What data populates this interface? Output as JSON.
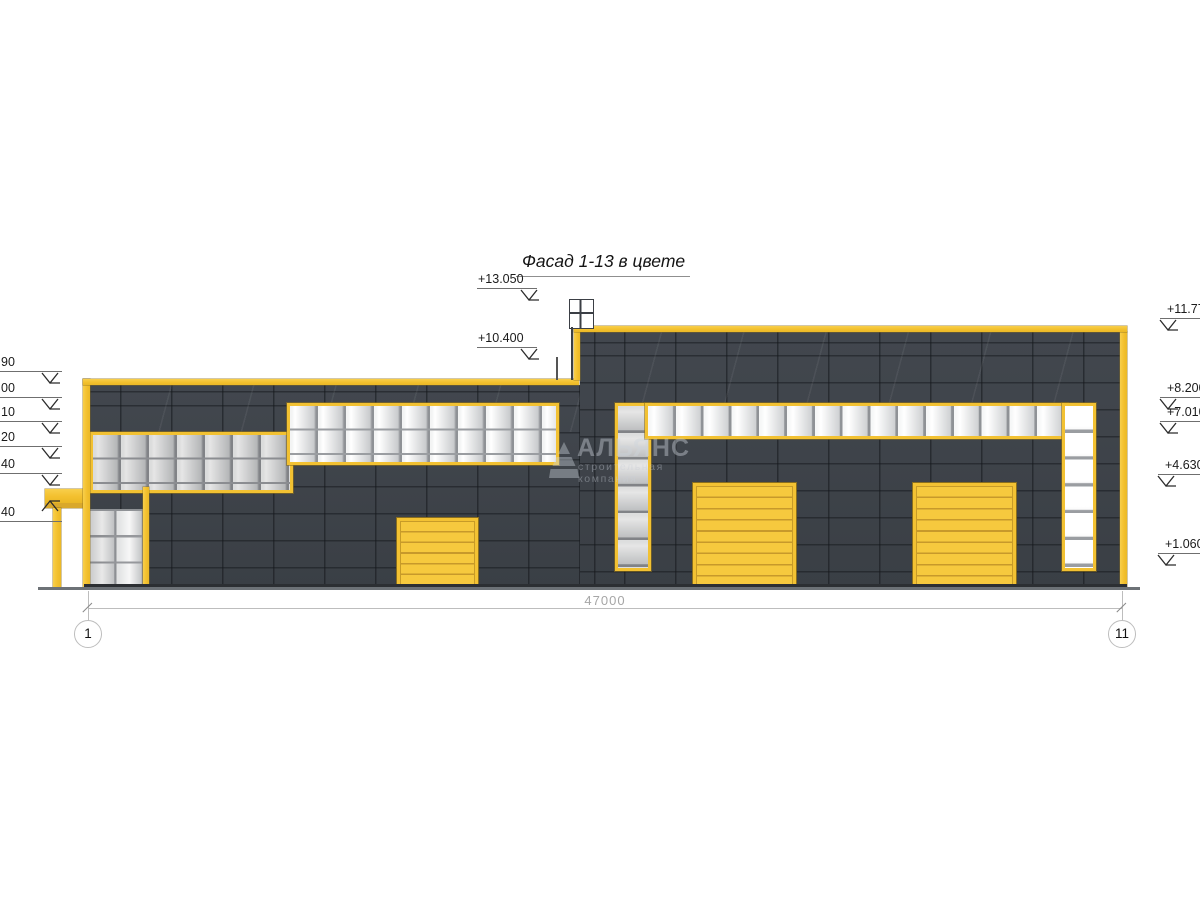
{
  "drawing": {
    "title": "Фасад 1-13 в цвете",
    "dimension_total": "47000",
    "axis_left": "1",
    "axis_right": "11",
    "watermark": {
      "name": "АЛЬЯНС",
      "tagline": "строительная компания"
    },
    "elevation_markers": [
      {
        "label": "+13.050",
        "tx": 478,
        "tw": 52,
        "x": 477,
        "w": 60,
        "y": 288,
        "ax": 528,
        "dir": "down"
      },
      {
        "label": "+10.400",
        "tx": 478,
        "tw": 52,
        "x": 477,
        "w": 60,
        "y": 347,
        "ax": 528,
        "dir": "down"
      },
      {
        "label": "+11.770",
        "tx": 1167,
        "tw": 60,
        "x": 1160,
        "w": 40,
        "y": 318,
        "ax": 1167,
        "dir": "down"
      },
      {
        "label": "+8.200",
        "tx": 1167,
        "tw": 60,
        "x": 1160,
        "w": 40,
        "y": 397,
        "ax": 1167,
        "dir": "down"
      },
      {
        "label": "+7.010",
        "tx": 1167,
        "tw": 60,
        "x": 1160,
        "w": 40,
        "y": 421,
        "ax": 1167,
        "dir": "down"
      },
      {
        "label": "+4.630",
        "tx": 1165,
        "tw": 60,
        "x": 1158,
        "w": 42,
        "y": 474,
        "ax": 1165,
        "dir": "down"
      },
      {
        "label": "+1.060",
        "tx": 1165,
        "tw": 60,
        "x": 1158,
        "w": 42,
        "y": 553,
        "ax": 1165,
        "dir": "down"
      },
      {
        "label": "90",
        "tx": 1,
        "tw": 26,
        "x": 0,
        "w": 62,
        "y": 371,
        "ax": 49,
        "dir": "down"
      },
      {
        "label": "00",
        "tx": 1,
        "tw": 26,
        "x": 0,
        "w": 62,
        "y": 397,
        "ax": 49,
        "dir": "down"
      },
      {
        "label": "10",
        "tx": 1,
        "tw": 26,
        "x": 0,
        "w": 62,
        "y": 421,
        "ax": 49,
        "dir": "down"
      },
      {
        "label": "20",
        "tx": 1,
        "tw": 26,
        "x": 0,
        "w": 62,
        "y": 446,
        "ax": 49,
        "dir": "down"
      },
      {
        "label": "40",
        "tx": 1,
        "tw": 26,
        "x": 0,
        "w": 62,
        "y": 473,
        "ax": 49,
        "dir": "down"
      },
      {
        "label": "40",
        "tx": 1,
        "tw": 26,
        "x": 0,
        "w": 62,
        "y": 521,
        "ax": 49,
        "dir": "up"
      }
    ],
    "colors": {
      "facade": "#3E4349",
      "accent_yellow": "#F3C233",
      "glass_light": "#FFFFFF",
      "glass_shade": "#B9BBBD",
      "ground": "#6D7277",
      "dimension": "#BDBDBD"
    }
  }
}
